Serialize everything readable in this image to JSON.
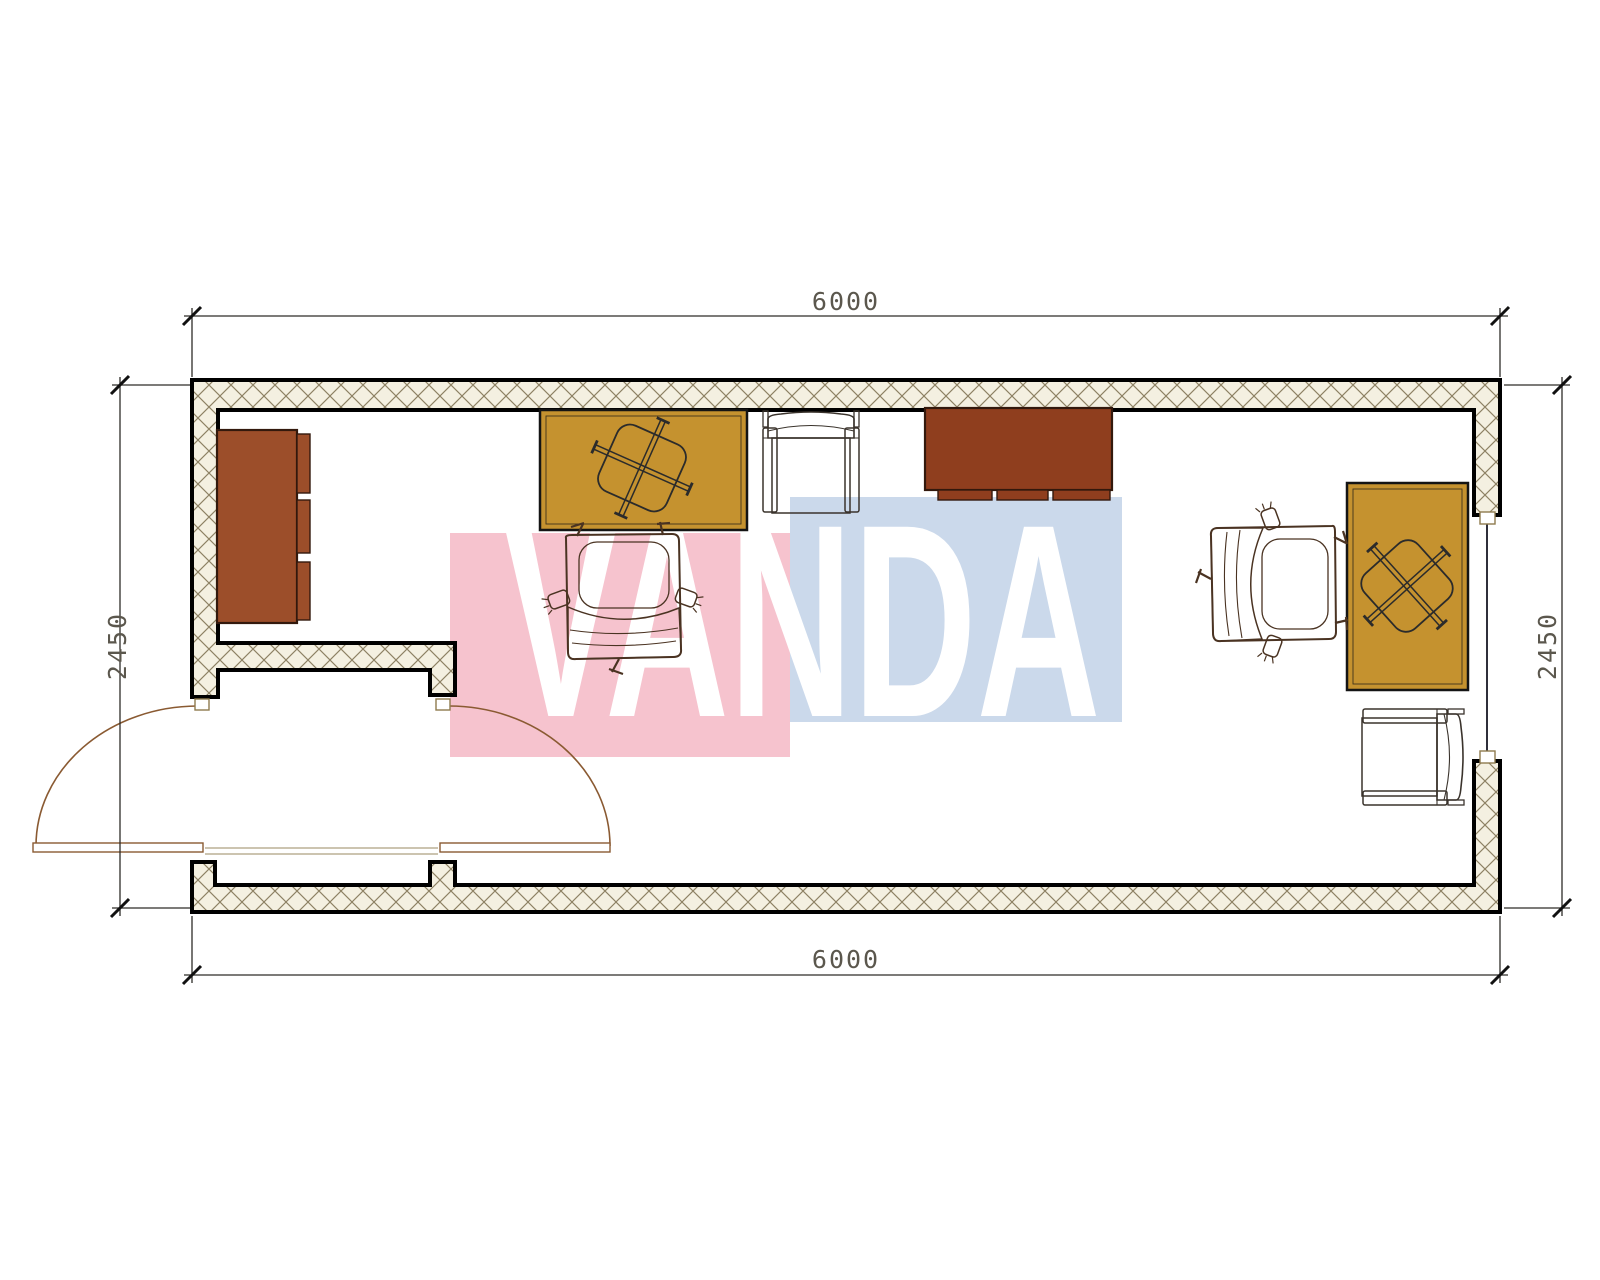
{
  "dimensions": {
    "top": "6000",
    "bottom": "6000",
    "left": "2450",
    "right": "2450"
  },
  "watermark": {
    "text": "VANDA",
    "pink": "#F6C3CE",
    "blue": "#CBD9EB",
    "text_color": "#FFFFFF"
  },
  "palette": {
    "hatch_bg": "#F4F0E1",
    "hatch_line": "#8D8163",
    "wall_line": "#000000",
    "desk": "#C5922F",
    "wardrobe": "#9C4E2A",
    "sideboard": "#8F3E1E",
    "chair_seat": "#7D8C77",
    "chair_back": "#6FB996",
    "armchair": "#B5A69A",
    "dim_text": "#5B574D"
  },
  "furniture": [
    {
      "id": "wardrobe",
      "fill": "wardrobe"
    },
    {
      "id": "desk-1",
      "fill": "desk"
    },
    {
      "id": "task-chair-1",
      "fill": "chair_seat"
    },
    {
      "id": "armchair-1",
      "fill": "armchair"
    },
    {
      "id": "sideboard",
      "fill": "sideboard"
    },
    {
      "id": "task-chair-2",
      "fill": "chair_seat"
    },
    {
      "id": "desk-2",
      "fill": "desk"
    },
    {
      "id": "armchair-2",
      "fill": "armchair"
    }
  ]
}
